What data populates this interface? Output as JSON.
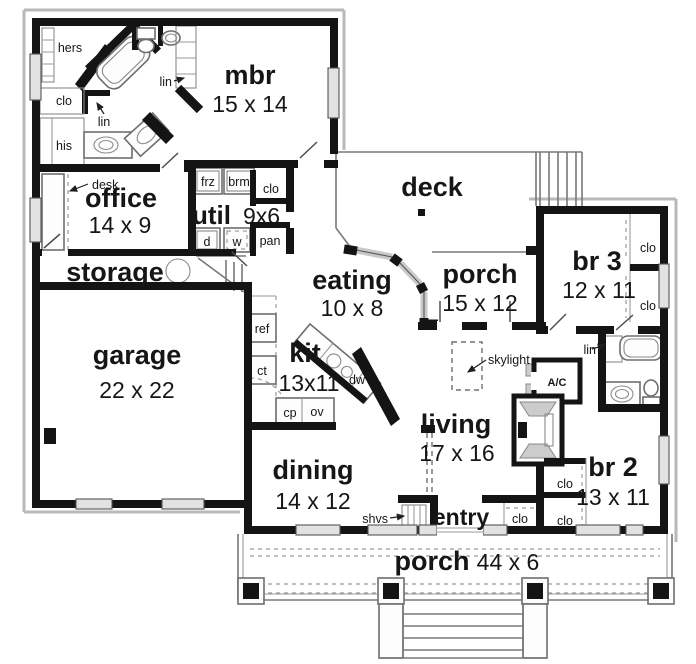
{
  "plan": {
    "rooms": {
      "mbr": {
        "name": "mbr",
        "dims": "15 x 14"
      },
      "office": {
        "name": "office",
        "dims": "14 x 9"
      },
      "util": {
        "name": "util",
        "dims": "9x6"
      },
      "storage": {
        "name": "storage"
      },
      "garage": {
        "name": "garage",
        "dims": "22 x 22"
      },
      "eating": {
        "name": "eating",
        "dims": "10 x 8"
      },
      "deck": {
        "name": "deck"
      },
      "porch_upper": {
        "name": "porch",
        "dims": "15 x 12"
      },
      "br3": {
        "name": "br 3",
        "dims": "12 x 11"
      },
      "kit": {
        "name": "kit",
        "dims": "13x11"
      },
      "living": {
        "name": "living",
        "dims": "17 x 16"
      },
      "dining": {
        "name": "dining",
        "dims": "14 x 12"
      },
      "entry": {
        "name": "entry"
      },
      "br2": {
        "name": "br 2",
        "dims": "13 x 11"
      },
      "porch_lower": {
        "name": "porch",
        "dims": "44 x 6"
      }
    },
    "labels": {
      "hers": "hers",
      "his": "his",
      "clo": "clo",
      "lin": "lin",
      "desk": "desk",
      "frz": "frz",
      "brm": "brm",
      "dryer": "d",
      "washer": "w",
      "pan": "pan",
      "ref": "ref",
      "ct": "ct",
      "cp": "cp",
      "ov": "ov",
      "dw": "dw",
      "shvs": "shvs",
      "skylight": "skylight",
      "ac": "A/C"
    },
    "colors": {
      "wall": "#141414",
      "thin_line": "#787878",
      "window": "#e2e2e2",
      "background": "#ffffff"
    }
  }
}
